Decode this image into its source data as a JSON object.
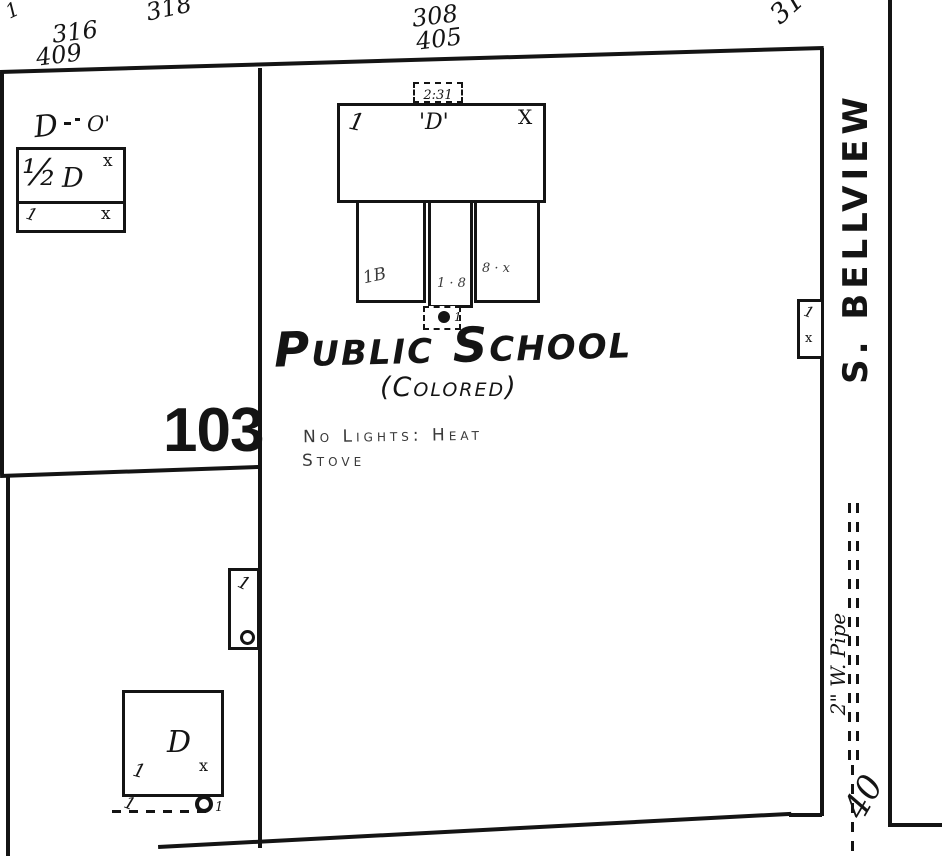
{
  "colors": {
    "paper": "#ffffff",
    "ink": "#141414",
    "faint_ink": "#3a3a3a"
  },
  "block": {
    "number": "103"
  },
  "street": {
    "name": "S. BELLVIEW",
    "width_mark": "40",
    "pipe_label": "2\" W. Pipe"
  },
  "school": {
    "title": "Public School",
    "subtitle": "(Colored)",
    "note_line1": "No Lights: Heat",
    "note_line2": "Stove",
    "roof_mark": "2:31",
    "main_marks": {
      "left": "1",
      "center": "'D'",
      "right": "X"
    },
    "wing_marks": {
      "left": "1B",
      "middle": "1 · 8",
      "right": "8 · x"
    },
    "outbuilding_mark": "1"
  },
  "porches": {
    "street": {
      "top": "1",
      "bottom": "x"
    },
    "west": {
      "top": "1"
    }
  },
  "dwellings": {
    "northwest": {
      "story": "½",
      "label": "D",
      "corner_mark": "x",
      "strip_left": "1",
      "strip_right": "x",
      "above_label": "D",
      "above_mark": "O'"
    },
    "southwest": {
      "label": "D",
      "mark_left": "1",
      "mark_right": "x",
      "porch_mark": "1",
      "porch_tick": "1"
    }
  },
  "house_numbers": {
    "stray_mark": "1",
    "left_upper": "318",
    "left_pair_top": "316",
    "left_pair_bottom": "409",
    "center_pair_top": "308",
    "center_pair_bottom": "405",
    "right_partial": "31"
  }
}
